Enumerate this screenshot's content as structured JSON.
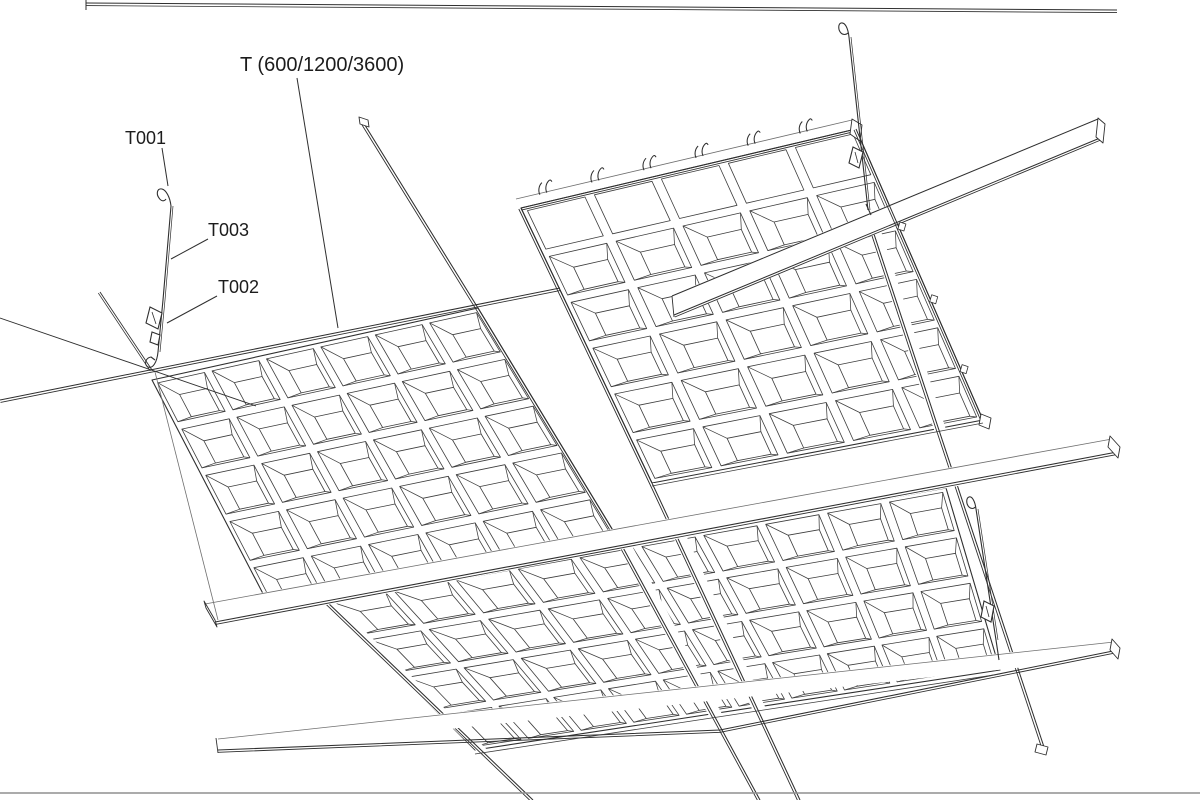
{
  "diagram": {
    "description": "Axonometric line drawing of a suspended ceiling grid with coffered (waffle) metal panels, main tee runners, cross tees and suspension hanger wires",
    "labels": {
      "tee_runner": "T (600/1200/3600)",
      "hanger_hook": "T001",
      "hanger_wire": "T003",
      "hanger_clip": "T002"
    },
    "colors": {
      "background": "#ffffff",
      "line": "#2f2f2f",
      "light_line": "#6f6f6f",
      "border_line": "#8f8f8f"
    }
  }
}
